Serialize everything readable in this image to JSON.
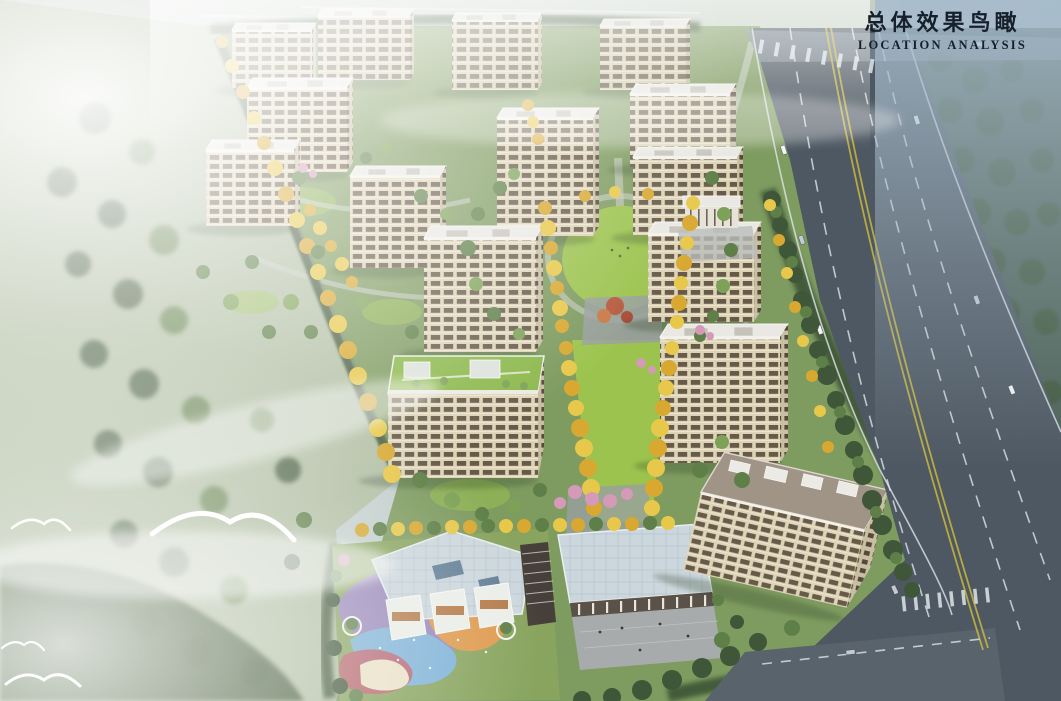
{
  "title": {
    "cn": "总体效果鸟瞰",
    "en": "LOCATION ANALYSIS"
  },
  "colors": {
    "sky_top": "#e9eef0",
    "sky_right": "#9fb2c0",
    "mist": "#f2f5f4",
    "forest": "#4d6156",
    "tree_dark": "#3f5639",
    "tree_green": "#5e7f47",
    "tree_light": "#7da257",
    "tree_gold": "#d8a830",
    "tree_gold_light": "#e8c84a",
    "tree_pink": "#d49ab8",
    "field": "#b2bfa4",
    "ground": "#7e9b60",
    "lawn": "#9cc34e",
    "lawn_roof": "#8cb84c",
    "path": "#c8cdc5",
    "plaza": "#9aa0a0",
    "road": "#4e5862",
    "road_light": "#7e8b96",
    "lane_white": "#dfe5e9",
    "lane_yellow": "#c4b23e",
    "facade": "#ddd4b8",
    "facade_shade": "#c9bfa2",
    "win": "#675a49",
    "win_dark": "#56493c",
    "roof_white": "#e9e8e3",
    "roof_brown": "#a09486",
    "roof_blue": "#ccd7dd",
    "kg_purple": "#9a86c0",
    "kg_blue": "#7fb3d9",
    "kg_orange": "#df9a4e",
    "kg_red": "#bb5f6e",
    "kg_cream": "#ece3c8",
    "title": "#15202c",
    "bird": "#ffffff"
  }
}
